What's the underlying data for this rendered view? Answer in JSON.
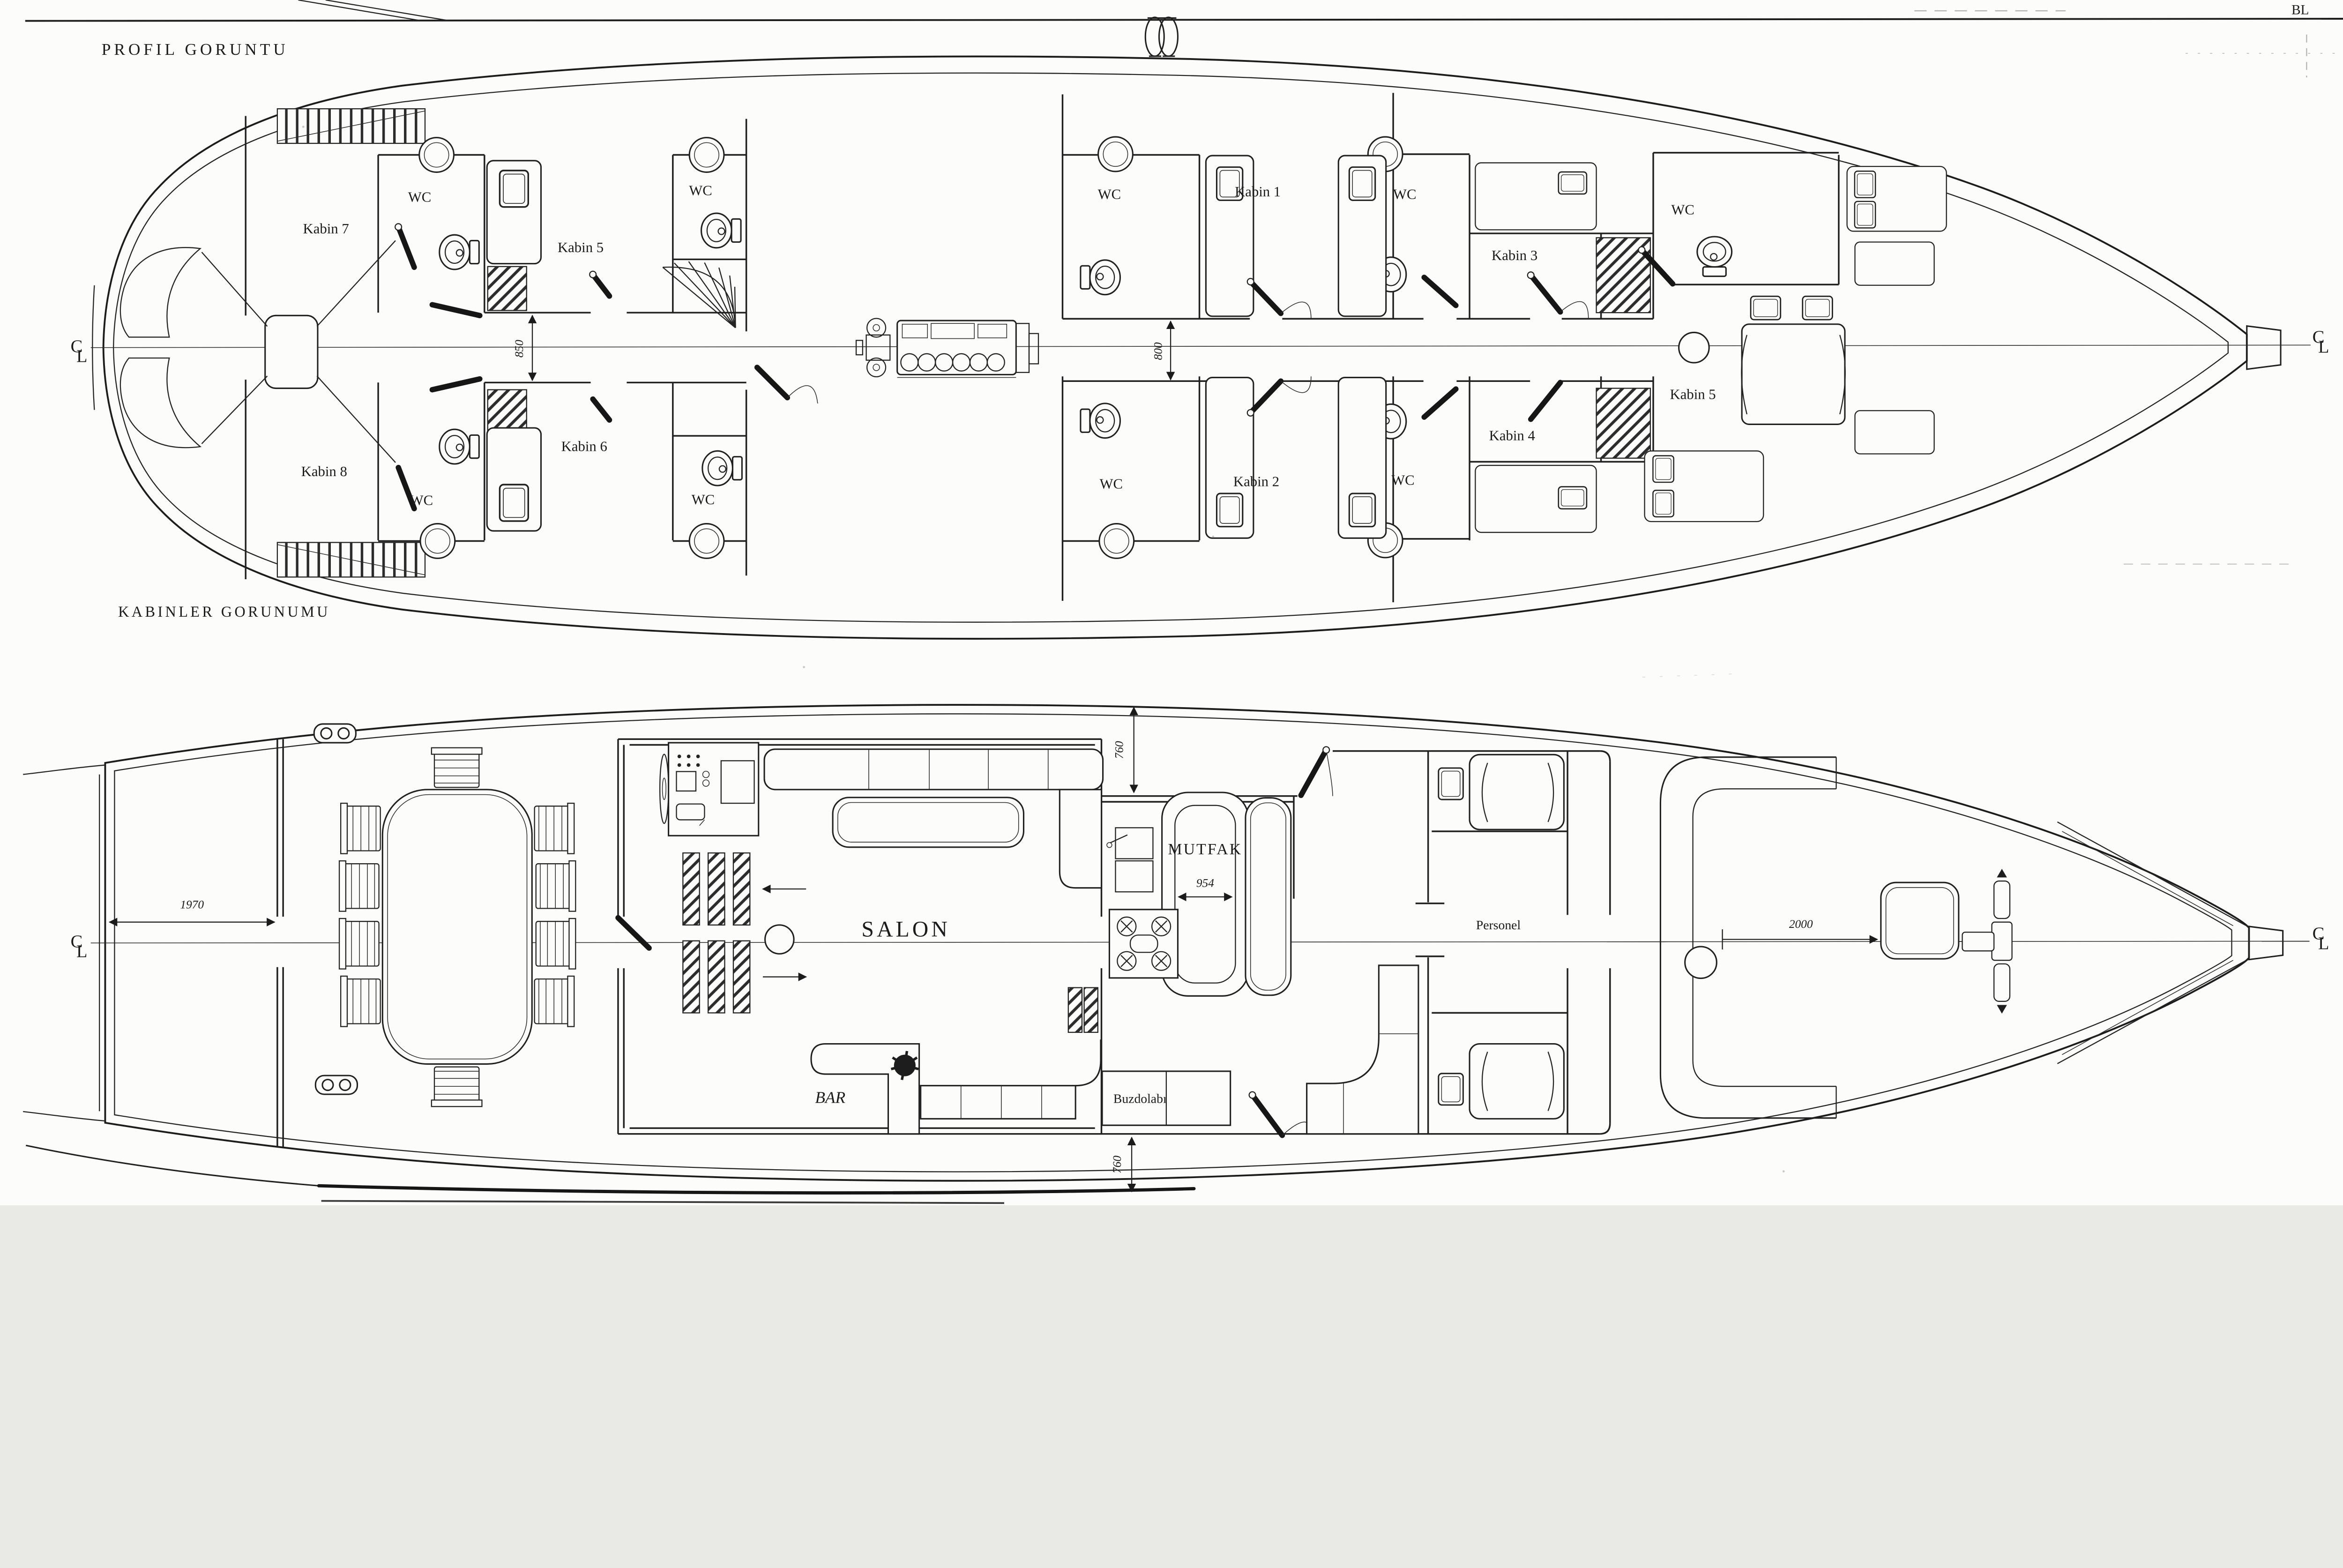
{
  "titles": {
    "profile": "PROFIL GORUNTU",
    "cabins": "KABINLER GORUNUMU"
  },
  "marks": {
    "baseline": "BL",
    "centerline_c": "C",
    "centerline_l": "L"
  },
  "upper": {
    "wc": "WC",
    "cabins": {
      "k1": "Kabin 1",
      "k2": "Kabin 2",
      "k3": "Kabin 3",
      "k4": "Kabin 4",
      "k5_mid": "Kabin 5",
      "k5_bow": "Kabin 5",
      "k6": "Kabin 6",
      "k7": "Kabin 7",
      "k8": "Kabin 8"
    },
    "dims": {
      "corridor_aft": "850",
      "corridor_fwd": "800"
    }
  },
  "lower": {
    "rooms": {
      "salon": "SALON",
      "bar": "BAR",
      "galley": "MUTFAK",
      "fridge": "Buzdolabı",
      "crew": "Personel"
    },
    "dims": {
      "aft_deck": "1970",
      "galley_width": "954",
      "fore_deck": "2000",
      "side_deck_top": "760",
      "side_deck_bottom": "760"
    }
  }
}
